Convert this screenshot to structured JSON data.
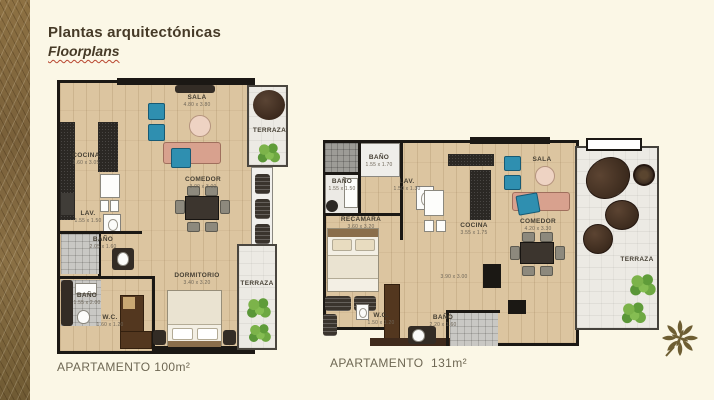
{
  "header": {
    "title": "Plantas arquitectónicas",
    "subtitle": "Floorplans"
  },
  "colors": {
    "background": "#fbf7e6",
    "band_brown": "#87693c",
    "wood": "#dcc5a0",
    "terrace": "#eceae4",
    "teal_accent": "#2f8fb0",
    "sofa_salmon": "#d8a18e",
    "plant_green": "#6ea842",
    "logo_olive": "#6e5e33",
    "wall": "#1b1814"
  },
  "icons": {
    "plant": "plant-icon",
    "logo": "leaf-logo-icon"
  },
  "plan_a": {
    "caption": "APARTAMENTO 100m²",
    "rooms": {
      "sala": {
        "name": "SALA",
        "dims": "4.80 x 3.80"
      },
      "comedor": {
        "name": "COMEDOR",
        "dims": "3.00 x 3.00"
      },
      "cocina": {
        "name": "COCINA",
        "dims": "3.60 x 3.05"
      },
      "lav": {
        "name": "LAV.",
        "dims": "1.55 x 1.50"
      },
      "bano_upper": {
        "name": "BAÑO",
        "dims": "2.05 x 1.60"
      },
      "bano_lower": {
        "name": "BAÑO",
        "dims": "1.55 x 2.00"
      },
      "wc": {
        "name": "W.C.",
        "dims": "1.60 x 1.20"
      },
      "dormitorio": {
        "name": "DORMITORIO",
        "dims": "3.40 x 3.20"
      },
      "terraza_top": {
        "name": "TERRAZA"
      },
      "terraza_bottom": {
        "name": "TERRAZA"
      }
    }
  },
  "plan_b": {
    "caption": "APARTAMENTO  131m²",
    "rooms": {
      "bano_1": {
        "name": "BAÑO",
        "dims": "1.55 x 1.70"
      },
      "bano_2": {
        "name": "BAÑO",
        "dims": "1.55 x 1.50"
      },
      "lav": {
        "name": "LAV.",
        "dims": "1.50 x 1.30"
      },
      "recamara": {
        "name": "RECAMARA",
        "dims": "3.60 x 3.20"
      },
      "cocina": {
        "name": "COCINA",
        "dims": "3.55 x 1.75"
      },
      "sala": {
        "name": "SALA"
      },
      "comedor": {
        "name": "COMEDOR",
        "dims": "4.20 x 3.30"
      },
      "open": {
        "dims": "3.90 x 3.00"
      },
      "wc": {
        "name": "W.C.",
        "dims": "1.50 x 1.20"
      },
      "bano_3": {
        "name": "BAÑO",
        "dims": "2.20 x 1.60"
      },
      "terraza": {
        "name": "TERRAZA"
      }
    }
  }
}
